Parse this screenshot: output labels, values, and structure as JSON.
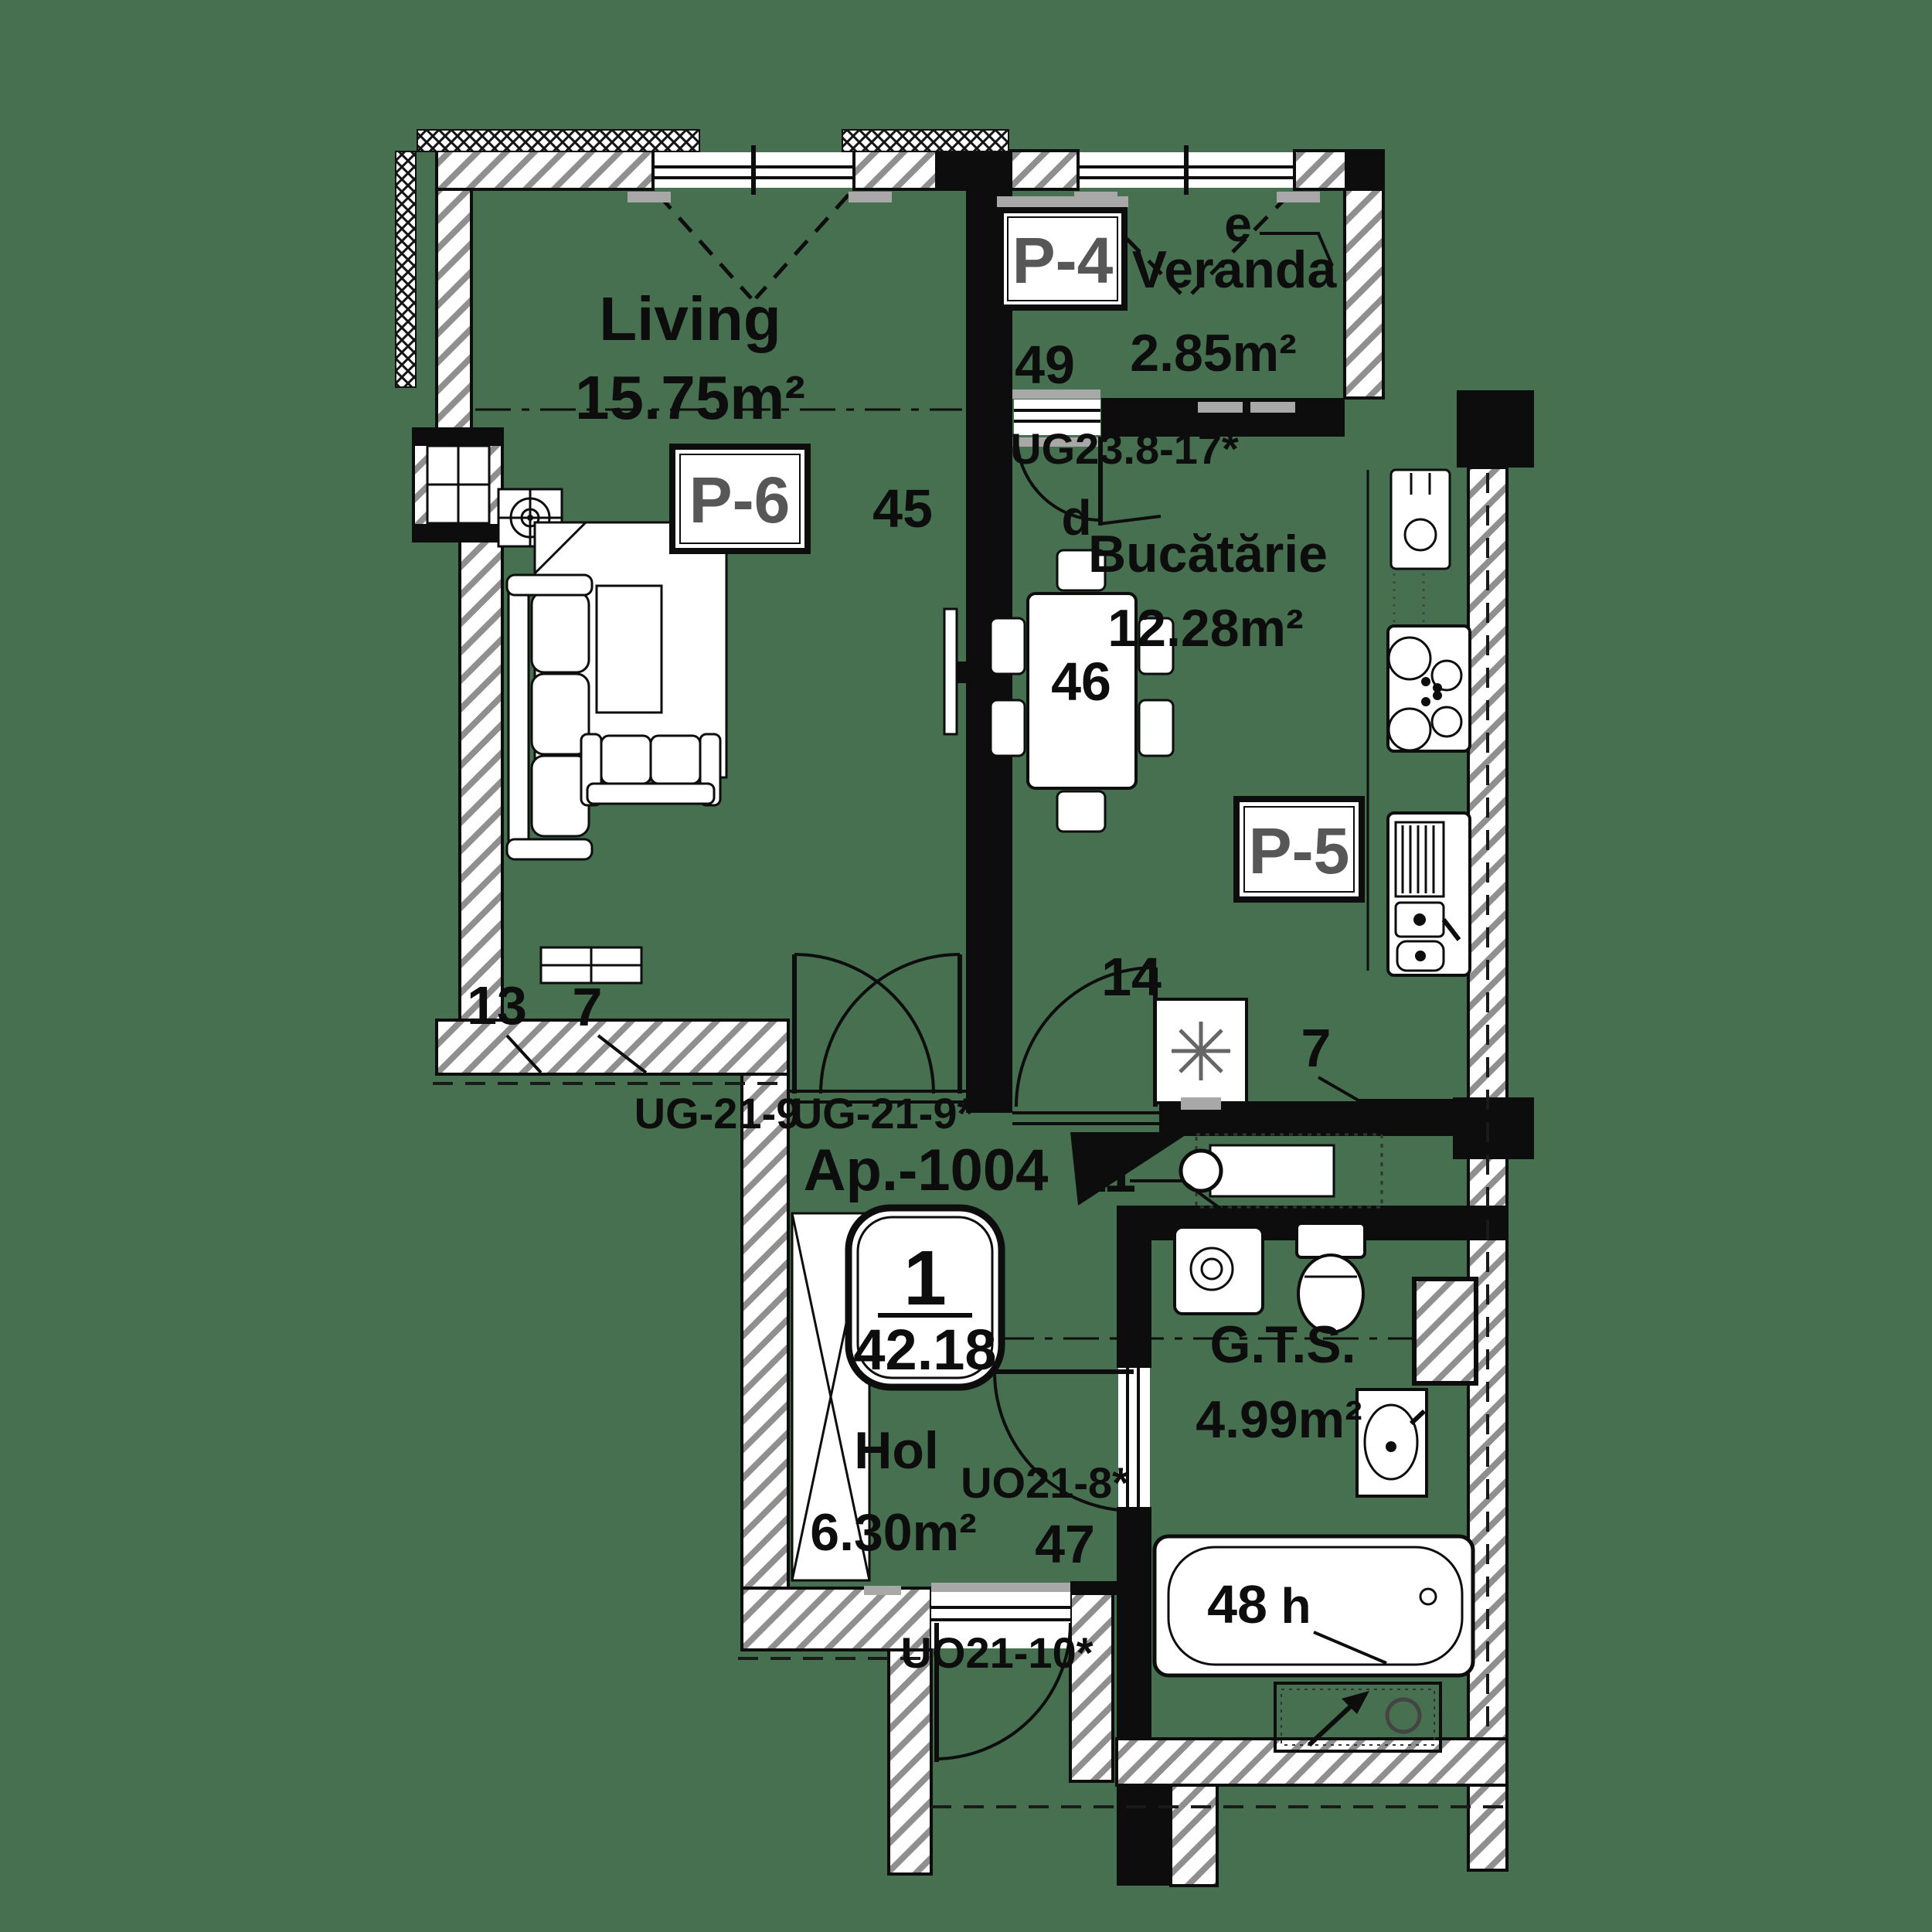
{
  "colors": {
    "background": "#477050",
    "ink": "#0d0d0d",
    "tag": "#575757",
    "pad": "#a8a8a8"
  },
  "plan": {
    "apartment": {
      "label": "Ap.-1004",
      "unit": "11",
      "badge_rooms": "1",
      "badge_area": "42.18"
    },
    "rooms": {
      "living": {
        "name": "Living",
        "area": "15.75m²",
        "zone": "45"
      },
      "veranda": {
        "name": "Veranda",
        "area": "2.85m²",
        "zone": "49",
        "axis": "e"
      },
      "kitchen": {
        "name": "Bucătărie",
        "area": "12.28m²",
        "zone": "46",
        "axis": "d"
      },
      "hall": {
        "name": "Hol",
        "area": "6.30m²",
        "zone": "47"
      },
      "bathroom": {
        "name": "G.T.S.",
        "area": "4.99m²",
        "zone": "48",
        "axis": "h"
      }
    },
    "tags": {
      "p4": "P-4",
      "p5": "P-5",
      "p6": "P-6"
    },
    "doors": {
      "veranda_kitchen": "UG23.8-17*",
      "living_left": "UG-21-9",
      "living_right": "UG-21-9*",
      "bathroom": "UO21-8*",
      "entry": "UO21-10*"
    },
    "details": {
      "n13": "13",
      "n7_living": "7",
      "n14": "14",
      "n7_kitchen": "7"
    }
  }
}
